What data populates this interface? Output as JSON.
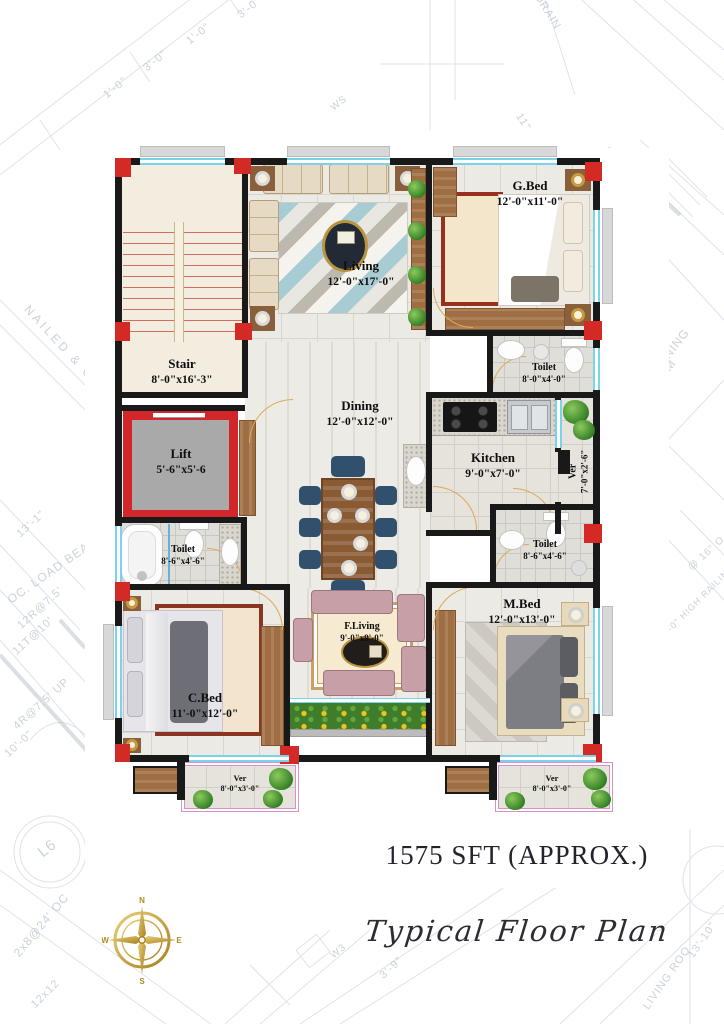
{
  "title_block": {
    "area": "1575 SFT (APPROX.)",
    "plan_name": "Typical Floor Plan"
  },
  "compass": {
    "n": "N",
    "s": "S",
    "e": "E",
    "w": "W"
  },
  "rooms": {
    "stair": {
      "name": "Stair",
      "dims": "8'-0\"x16'-3\""
    },
    "living": {
      "name": "Living",
      "dims": "12'-0\"x17'-0\""
    },
    "gbed": {
      "name": "G.Bed",
      "dims": "12'-0\"x11'-0\""
    },
    "toilet_top": {
      "name": "Toilet",
      "dims": "8'-0\"x4'-0\""
    },
    "dining": {
      "name": "Dining",
      "dims": "12'-0\"x12'-0\""
    },
    "kitchen": {
      "name": "Kitchen",
      "dims": "9'-0\"x7'-0\""
    },
    "ver_right": {
      "name": "Ver",
      "dims": "7'-0\"x2'-6\""
    },
    "lift": {
      "name": "Lift",
      "dims": "5'-6\"x5'-6"
    },
    "toilet_left": {
      "name": "Toilet",
      "dims": "8'-6\"x4'-6\""
    },
    "toilet_right": {
      "name": "Toilet",
      "dims": "8'-6\"x4'-6\""
    },
    "cbed": {
      "name": "C.Bed",
      "dims": "11'-0\"x12'-0\""
    },
    "f_living": {
      "name": "F.Living",
      "dims": "9'-0\"x9'-0\""
    },
    "mbed": {
      "name": "M.Bed",
      "dims": "12'-0\"x13'-0\""
    },
    "ver_bl": {
      "name": "Ver",
      "dims": "8'-0\"x3'-0\""
    },
    "ver_br": {
      "name": "Ver",
      "dims": "8'-0\"x3'-0\""
    }
  },
  "bg": {
    "texts": [
      {
        "label": "DRAIN"
      },
      {
        "label": "3'-0\""
      },
      {
        "label": "1'-0\""
      },
      {
        "label": "3'-0\""
      },
      {
        "label": "1'-0\""
      },
      {
        "label": "WS"
      },
      {
        "label": "11\""
      },
      {
        "label": "NAILED & GLUED"
      },
      {
        "label": "13'-1\""
      },
      {
        "label": "OC. LOAD BEA"
      },
      {
        "label": "12R@7.5'"
      },
      {
        "label": "11T@10'"
      },
      {
        "label": "4R@7.5' UP"
      },
      {
        "label": "10'-0\""
      },
      {
        "label": "L6"
      },
      {
        "label": "2x8@24' OC"
      },
      {
        "label": "12x12"
      },
      {
        "label": "DINING"
      },
      {
        "label": "ROOM"
      },
      {
        "label": "@ 16\" O"
      },
      {
        "label": "3'-0\" HIGH RAILING"
      },
      {
        "label": "W3"
      },
      {
        "label": "3'-9\""
      },
      {
        "label": "13'-10\""
      },
      {
        "label": "LIVING ROO"
      }
    ]
  },
  "colors": {
    "wall": "#191919",
    "column_red": "#d32a26",
    "window_cyan": "#7ed2e8",
    "compass_gold": "#c09a2e",
    "veranda_border": "#d791c6",
    "flower_green": "#3f7d2a"
  }
}
